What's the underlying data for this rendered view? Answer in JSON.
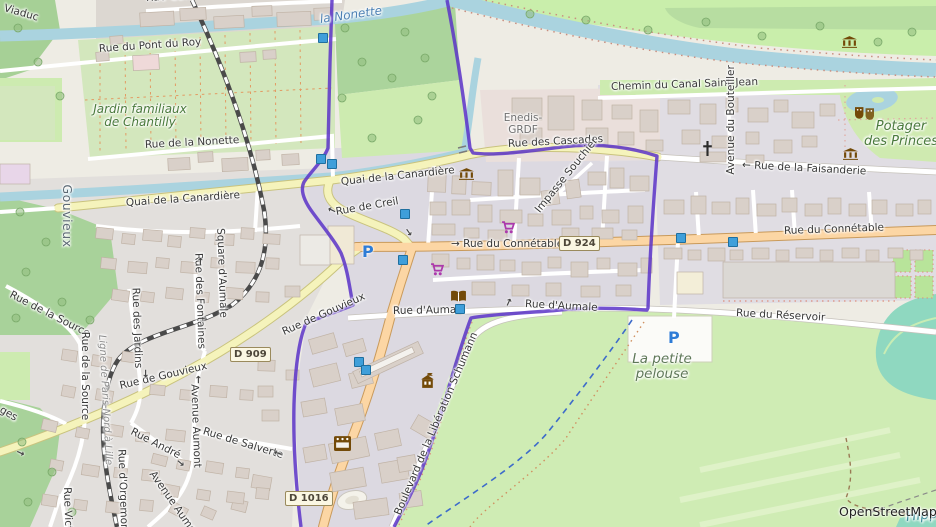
{
  "attribution": "OpenStreetMap",
  "colors": {
    "boundary_purple": "#5b32c8",
    "water": "#aad3df",
    "primary_road": "#fcd6a4",
    "secondary_road": "#f5f3bb",
    "forest": "#a8d29a",
    "grass": "#cdebb0",
    "park": "#c9eeab",
    "allotment": "#d3e7bd",
    "residential": "#dcd9e1",
    "building": "#d9d0c9",
    "pitch_teal": "#8fd8c0",
    "parking_blue": "#2e7cd6",
    "signal_blue": "#3f9fda"
  },
  "labels": {
    "viaduc": "Viaduc",
    "rue_gan": "Rue Gan",
    "pont_du_roy": "Rue du Pont du Roy",
    "jardin_familiaux": "Jardin familiaux\nde Chantilly",
    "rue_de_la_nonette": "Rue de la Nonette",
    "la_nonette": "la Nonette",
    "chemin_canal": "Chemin du Canal Saint-Jean",
    "avenue_bouteiller": "Avenue du Bouteiller",
    "potager_des_princes": "Potager\ndes Princes",
    "faisanderie": "← Rue de la Faisanderie",
    "enedis": "Enedis-\nGRDF",
    "cascades": "Rue des Cascades",
    "impasse_souchier": "Impasse Souchier",
    "quai_canardiere_w": "Quai de la Canardière",
    "quai_canardiere_e": "Quai de la Canardière",
    "rue_de_creil": "Rue de Creil",
    "connetable_c": "→ Rue du Connétable",
    "connetable_e": "Rue du Connétable",
    "reservoir": "Rue du Réservoir",
    "aumale_w": "Rue d'Aumale",
    "aumale_e": "Rue d'Aumale",
    "petite_pelouse": "La petite\npelouse",
    "boulevard_liberation": "Boulevard de la Libération Schumann",
    "gouvieux_diag": "Rue de Gouvieux",
    "gouvieux_d909": "Rue de Gouvieux",
    "source_diag": "Rue de la Source",
    "source_vert": "Rue de la Source",
    "rue_des_jardins": "Rue des Jardins",
    "rue_des_fontaines": "Rue des Fontaines",
    "square_aumale": "Square d'Aumale",
    "gouvieux_place": "Gouvieux",
    "ligne_paris": "Ligne de Paris-Nord à Lille",
    "rue_andre": "Rue André",
    "avenue_aumont_v": "Avenue Aumont",
    "avenue_aumont_d": "Avenue Aumont",
    "salverte": "Rue de Salverte",
    "orgemont": "Rue d'Orgemont",
    "rue_victor": "Rue Victor",
    "ges_partial": "ges",
    "hippodrome_partial": "Hippod",
    "openstreetmap": "OpenStreetMap"
  },
  "shields": {
    "d924": "D 924",
    "d909": "D 909",
    "d1016": "D 1016"
  },
  "icons": {
    "museum-icon": "classical building (columns)",
    "library-icon": "open book",
    "shop-icon": "shopping cart",
    "worship-icon": "christian cross",
    "theatre-icon": "theatre masks",
    "townhall-icon": "building with flag",
    "cinema-icon": "film strip",
    "parking-icon": "P",
    "traffic-signal-icon": "blue square",
    "oneway-arrow": "→",
    "tree-icon": "green circle"
  },
  "map_features": {
    "signals": [
      [
        322,
        37
      ],
      [
        320,
        158
      ],
      [
        331,
        163
      ],
      [
        404,
        213
      ],
      [
        402,
        259
      ],
      [
        459,
        308
      ],
      [
        358,
        361
      ],
      [
        365,
        369
      ],
      [
        680,
        237
      ],
      [
        732,
        241
      ]
    ],
    "arrows": [
      [
        328,
        204,
        205
      ],
      [
        404,
        227,
        55
      ],
      [
        176,
        458,
        40
      ],
      [
        195,
        374,
        -90
      ],
      [
        197,
        256,
        -90
      ],
      [
        141,
        368,
        90
      ],
      [
        505,
        297,
        -65
      ],
      [
        274,
        447,
        197
      ],
      [
        16,
        448,
        25
      ]
    ],
    "trees": [
      [
        18,
        28
      ],
      [
        38,
        62
      ],
      [
        60,
        96
      ],
      [
        20,
        212
      ],
      [
        46,
        242
      ],
      [
        26,
        272
      ],
      [
        62,
        302
      ],
      [
        16,
        318
      ],
      [
        90,
        320
      ],
      [
        22,
        442
      ],
      [
        52,
        472
      ],
      [
        28,
        502
      ],
      [
        72,
        512
      ],
      [
        345,
        28
      ],
      [
        405,
        32
      ],
      [
        362,
        62
      ],
      [
        342,
        98
      ],
      [
        392,
        78
      ],
      [
        418,
        120
      ],
      [
        372,
        138
      ],
      [
        432,
        96
      ],
      [
        425,
        58
      ],
      [
        648,
        30
      ],
      [
        706,
        22
      ],
      [
        762,
        36
      ],
      [
        820,
        26
      ],
      [
        878,
        42
      ],
      [
        912,
        32
      ],
      [
        586,
        20
      ],
      [
        530,
        14
      ]
    ],
    "buildings": [
      [
        140,
        12,
        34,
        14,
        -3
      ],
      [
        180,
        8,
        26,
        12,
        -3
      ],
      [
        214,
        16,
        30,
        12,
        -3
      ],
      [
        252,
        6,
        20,
        10,
        -2
      ],
      [
        277,
        12,
        34,
        14,
        -2
      ],
      [
        314,
        8,
        18,
        12,
        -2
      ],
      [
        240,
        52,
        16,
        10,
        -3
      ],
      [
        263,
        50,
        13,
        9,
        -3
      ],
      [
        96,
        52,
        13,
        9,
        -4
      ],
      [
        110,
        36,
        13,
        8,
        -4
      ],
      [
        168,
        158,
        22,
        12,
        -3
      ],
      [
        198,
        152,
        15,
        10,
        -3
      ],
      [
        222,
        158,
        26,
        13,
        -3
      ],
      [
        256,
        150,
        14,
        10,
        -3
      ],
      [
        282,
        154,
        17,
        11,
        -3
      ],
      [
        512,
        98,
        30,
        22,
        0
      ],
      [
        548,
        96,
        26,
        34,
        0
      ],
      [
        582,
        100,
        20,
        20,
        0
      ],
      [
        520,
        128,
        22,
        16,
        0
      ],
      [
        586,
        128,
        22,
        17,
        0
      ],
      [
        612,
        105,
        20,
        14,
        0
      ],
      [
        640,
        110,
        18,
        22,
        0
      ],
      [
        618,
        132,
        16,
        13,
        0
      ],
      [
        646,
        140,
        17,
        11,
        0
      ],
      [
        668,
        100,
        22,
        14,
        0
      ],
      [
        700,
        104,
        16,
        20,
        0
      ],
      [
        726,
        98,
        12,
        14,
        0
      ],
      [
        748,
        108,
        20,
        14,
        0
      ],
      [
        774,
        100,
        14,
        12,
        0
      ],
      [
        792,
        112,
        22,
        16,
        0
      ],
      [
        820,
        104,
        15,
        12,
        0
      ],
      [
        682,
        130,
        18,
        14,
        0
      ],
      [
        712,
        136,
        22,
        12,
        0
      ],
      [
        746,
        132,
        13,
        12,
        0
      ],
      [
        774,
        140,
        18,
        13,
        0
      ],
      [
        802,
        136,
        15,
        11,
        0
      ],
      [
        700,
        152,
        26,
        10,
        0
      ],
      [
        746,
        155,
        18,
        8,
        0
      ],
      [
        428,
        168,
        18,
        24,
        2
      ],
      [
        452,
        176,
        14,
        18,
        2
      ],
      [
        472,
        182,
        19,
        13,
        2
      ],
      [
        430,
        202,
        16,
        13,
        0
      ],
      [
        452,
        200,
        18,
        15,
        0
      ],
      [
        478,
        205,
        14,
        17,
        0
      ],
      [
        498,
        170,
        15,
        26,
        0
      ],
      [
        520,
        178,
        20,
        17,
        0
      ],
      [
        542,
        190,
        17,
        15,
        -8
      ],
      [
        566,
        180,
        14,
        18,
        -8
      ],
      [
        588,
        172,
        18,
        13,
        0
      ],
      [
        610,
        168,
        14,
        20,
        0
      ],
      [
        630,
        176,
        19,
        15,
        0
      ],
      [
        500,
        210,
        22,
        13,
        0
      ],
      [
        528,
        214,
        15,
        12,
        0
      ],
      [
        552,
        210,
        19,
        15,
        0
      ],
      [
        580,
        206,
        13,
        13,
        0
      ],
      [
        602,
        210,
        17,
        13,
        0
      ],
      [
        628,
        206,
        15,
        17,
        0
      ],
      [
        432,
        224,
        23,
        11,
        0
      ],
      [
        464,
        228,
        15,
        10,
        0
      ],
      [
        488,
        230,
        19,
        11,
        0
      ],
      [
        562,
        228,
        17,
        10,
        0
      ],
      [
        592,
        228,
        21,
        11,
        0
      ],
      [
        622,
        230,
        15,
        10,
        0
      ],
      [
        432,
        254,
        17,
        13,
        0
      ],
      [
        457,
        258,
        13,
        11,
        0
      ],
      [
        477,
        255,
        17,
        15,
        0
      ],
      [
        500,
        260,
        15,
        11,
        0
      ],
      [
        522,
        262,
        19,
        13,
        0
      ],
      [
        548,
        257,
        13,
        11,
        0
      ],
      [
        571,
        262,
        17,
        15,
        0
      ],
      [
        597,
        258,
        13,
        11,
        0
      ],
      [
        618,
        263,
        19,
        13,
        0
      ],
      [
        641,
        258,
        11,
        15,
        0
      ],
      [
        472,
        282,
        23,
        13,
        0
      ],
      [
        512,
        285,
        17,
        11,
        0
      ],
      [
        546,
        283,
        15,
        13,
        0
      ],
      [
        581,
        286,
        19,
        11,
        0
      ],
      [
        616,
        285,
        15,
        11,
        0
      ],
      [
        664,
        200,
        20,
        14,
        0
      ],
      [
        691,
        196,
        15,
        18,
        0
      ],
      [
        712,
        202,
        18,
        12,
        0
      ],
      [
        736,
        198,
        13,
        16,
        0
      ],
      [
        757,
        204,
        19,
        12,
        0
      ],
      [
        782,
        198,
        15,
        14,
        0
      ],
      [
        805,
        204,
        17,
        12,
        0
      ],
      [
        828,
        198,
        13,
        16,
        0
      ],
      [
        849,
        204,
        17,
        12,
        0
      ],
      [
        872,
        200,
        15,
        14,
        0
      ],
      [
        896,
        204,
        17,
        12,
        0
      ],
      [
        918,
        200,
        13,
        14,
        0
      ],
      [
        664,
        248,
        18,
        11,
        0
      ],
      [
        688,
        250,
        13,
        10,
        0
      ],
      [
        708,
        248,
        17,
        13,
        0
      ],
      [
        730,
        250,
        13,
        10,
        0
      ],
      [
        752,
        248,
        17,
        11,
        0
      ],
      [
        776,
        250,
        13,
        11,
        0
      ],
      [
        796,
        248,
        17,
        10,
        0
      ],
      [
        820,
        250,
        13,
        11,
        0
      ],
      [
        842,
        248,
        17,
        10,
        0
      ],
      [
        866,
        250,
        13,
        11,
        0
      ],
      [
        888,
        248,
        15,
        10,
        0
      ],
      [
        910,
        250,
        13,
        10,
        0
      ],
      [
        96,
        228,
        17,
        11,
        6
      ],
      [
        122,
        234,
        13,
        10,
        6
      ],
      [
        143,
        230,
        19,
        11,
        5
      ],
      [
        168,
        236,
        13,
        11,
        5
      ],
      [
        190,
        228,
        15,
        10,
        4
      ],
      [
        215,
        234,
        19,
        11,
        3
      ],
      [
        241,
        228,
        13,
        11,
        3
      ],
      [
        263,
        234,
        17,
        10,
        3
      ],
      [
        101,
        258,
        15,
        11,
        6
      ],
      [
        128,
        262,
        19,
        11,
        5
      ],
      [
        156,
        258,
        13,
        10,
        5
      ],
      [
        181,
        262,
        17,
        11,
        4
      ],
      [
        211,
        258,
        13,
        10,
        3
      ],
      [
        236,
        262,
        19,
        11,
        2
      ],
      [
        266,
        258,
        13,
        11,
        2
      ],
      [
        112,
        290,
        17,
        11,
        8
      ],
      [
        141,
        292,
        13,
        10,
        7
      ],
      [
        166,
        288,
        17,
        11,
        6
      ],
      [
        196,
        292,
        13,
        10,
        5
      ],
      [
        226,
        288,
        17,
        11,
        4
      ],
      [
        256,
        292,
        13,
        10,
        2
      ],
      [
        285,
        286,
        15,
        11,
        0
      ],
      [
        258,
        360,
        17,
        11,
        2
      ],
      [
        258,
        386,
        15,
        11,
        0
      ],
      [
        262,
        410,
        17,
        11,
        0
      ],
      [
        286,
        370,
        13,
        10,
        0
      ],
      [
        62,
        350,
        15,
        11,
        9
      ],
      [
        92,
        356,
        19,
        11,
        9
      ],
      [
        122,
        352,
        13,
        10,
        8
      ],
      [
        62,
        386,
        13,
        11,
        11
      ],
      [
        96,
        390,
        17,
        11,
        10
      ],
      [
        150,
        385,
        15,
        10,
        5
      ],
      [
        180,
        390,
        13,
        10,
        5
      ],
      [
        210,
        386,
        17,
        11,
        4
      ],
      [
        240,
        390,
        13,
        10,
        3
      ],
      [
        42,
        420,
        15,
        11,
        13
      ],
      [
        76,
        428,
        13,
        10,
        11
      ],
      [
        106,
        425,
        17,
        11,
        9
      ],
      [
        136,
        432,
        13,
        10,
        7
      ],
      [
        166,
        430,
        19,
        11,
        6
      ],
      [
        50,
        460,
        13,
        10,
        11
      ],
      [
        82,
        465,
        17,
        11,
        9
      ],
      [
        114,
        468,
        13,
        10,
        7
      ],
      [
        142,
        470,
        17,
        11,
        6
      ],
      [
        42,
        495,
        15,
        11,
        9
      ],
      [
        74,
        500,
        13,
        10,
        8
      ],
      [
        106,
        502,
        17,
        11,
        6
      ],
      [
        140,
        500,
        13,
        11,
        5
      ],
      [
        170,
        505,
        17,
        11,
        28
      ],
      [
        202,
        508,
        13,
        10,
        24
      ],
      [
        232,
        500,
        15,
        11,
        14
      ],
      [
        252,
        476,
        19,
        13,
        10
      ],
      [
        152,
        455,
        15,
        10,
        14
      ],
      [
        177,
        460,
        13,
        10,
        11
      ],
      [
        206,
        462,
        17,
        11,
        9
      ],
      [
        236,
        468,
        13,
        10,
        7
      ],
      [
        162,
        485,
        17,
        11,
        11
      ],
      [
        197,
        490,
        13,
        10,
        9
      ],
      [
        227,
        492,
        17,
        11,
        7
      ],
      [
        256,
        488,
        13,
        11,
        5
      ],
      [
        310,
        336,
        26,
        15,
        -16
      ],
      [
        344,
        341,
        21,
        13,
        -16
      ],
      [
        311,
        366,
        28,
        18,
        -14
      ],
      [
        350,
        371,
        22,
        15,
        -14
      ],
      [
        302,
        400,
        24,
        15,
        -10
      ],
      [
        336,
        406,
        28,
        17,
        -11
      ],
      [
        330,
        440,
        38,
        20,
        -12
      ],
      [
        376,
        431,
        24,
        17,
        -12
      ],
      [
        331,
        470,
        34,
        19,
        -10
      ],
      [
        380,
        461,
        28,
        20,
        -10
      ],
      [
        304,
        446,
        22,
        15,
        -10
      ],
      [
        400,
        492,
        22,
        15,
        -8
      ],
      [
        354,
        500,
        34,
        17,
        -8
      ],
      [
        416,
        416,
        16,
        22,
        -60
      ],
      [
        398,
        456,
        18,
        15,
        -10
      ]
    ],
    "colored_buildings": [
      [
        133,
        55,
        26,
        15,
        -3,
        "#efd9d9"
      ],
      [
        0,
        164,
        30,
        20,
        0,
        "#e8d6e9"
      ],
      [
        328,
        226,
        26,
        38,
        0,
        "#f0e9d6"
      ],
      [
        300,
        235,
        30,
        30,
        0,
        "#eceae5"
      ],
      [
        677,
        272,
        26,
        22,
        0,
        "#f3eed8"
      ],
      [
        723,
        262,
        172,
        36,
        0,
        "#dbd8d4"
      ],
      [
        352,
        356,
        72,
        13,
        -25,
        "#d9d0c9"
      ],
      [
        358,
        359,
        58,
        6,
        -25,
        "#f4f2ee"
      ]
    ]
  }
}
